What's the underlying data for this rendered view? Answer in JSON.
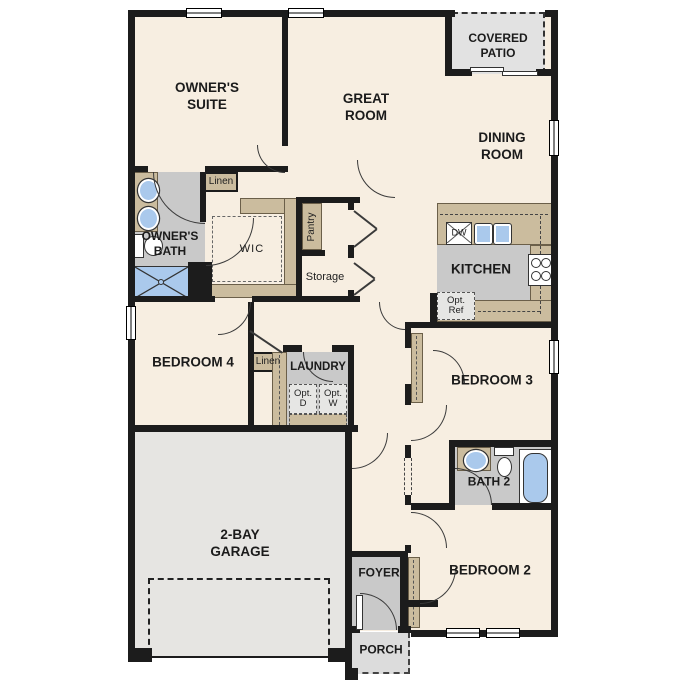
{
  "rooms": {
    "owners_suite": "OWNER'S SUITE",
    "great_room": "GREAT ROOM",
    "covered_patio": "COVERED PATIO",
    "dining_room": "DINING ROOM",
    "owners_bath": "OWNER'S BATH",
    "wic": "WIC",
    "kitchen": "KITCHEN",
    "bedroom4": "BEDROOM 4",
    "laundry": "LAUNDRY",
    "garage": "2-BAY GARAGE",
    "bedroom3": "BEDROOM 3",
    "bath2": "BATH 2",
    "bedroom2": "BEDROOM 2",
    "foyer": "FOYER",
    "porch": "PORCH"
  },
  "closets": {
    "linen_upper": "Linen",
    "linen_hall": "Linen",
    "pantry": "Pantry",
    "storage": "Storage"
  },
  "appliances": {
    "dishwasher": "DW",
    "opt_ref": "Opt. Ref",
    "opt_dryer": "Opt. D",
    "opt_washer": "Opt. W"
  },
  "colors": {
    "wall": "#1c1c1c",
    "floor": "#f7eee1",
    "casework": "#cbbc9e",
    "wet": "#c9c9c9",
    "patio": "#e2e2e2",
    "garage": "#e6e5e2",
    "porch": "#dcdcdc",
    "fixture": "#aac9ec",
    "optbox": "#e6e6e4",
    "line": "#3a3a3a"
  }
}
